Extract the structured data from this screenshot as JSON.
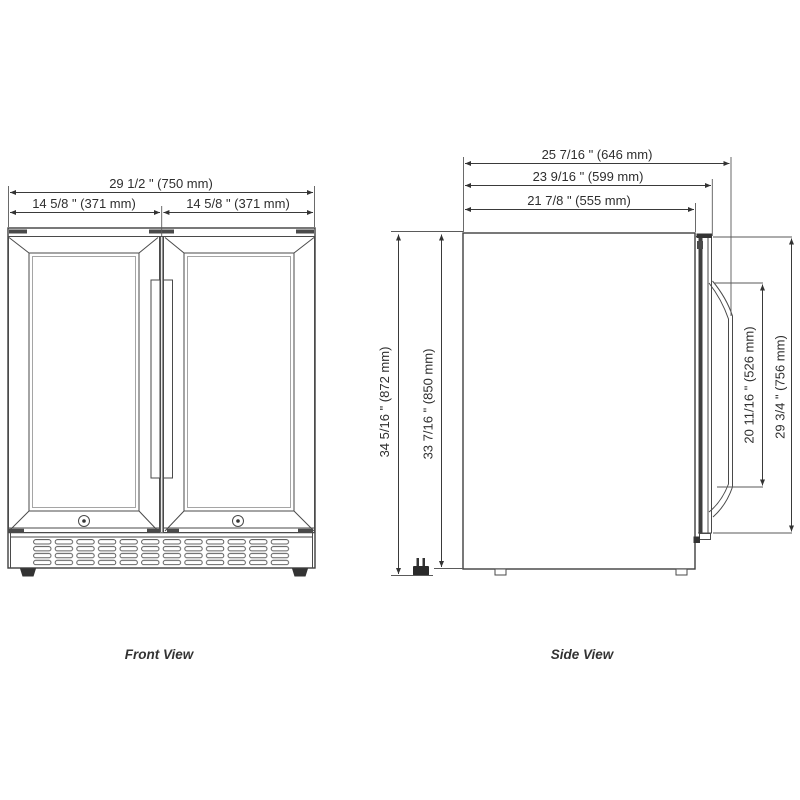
{
  "front_view": {
    "label": "Front View",
    "dimensions": {
      "overall_width": "29 1/2 \" (750 mm)",
      "left_door_width": "14 5/8 \" (371 mm)",
      "right_door_width": "14 5/8 \" (371 mm)"
    }
  },
  "side_view": {
    "label": "Side View",
    "dimensions": {
      "overall_depth": "25 7/16 \" (646 mm)",
      "depth_with_door": "23 9/16 \" (599 mm)",
      "body_depth": "21 7/8 \" (555 mm)",
      "overall_height": "34 5/16 \" (872 mm)",
      "body_height": "33 7/16 \" (850 mm)",
      "handle_length": "20 11/16 \" (526 mm)",
      "door_height": "29 3/4 \" (756 mm)"
    }
  },
  "colors": {
    "line": "#4a4a4a",
    "dimension_line": "#3a3a3a",
    "text": "#2e2e2e",
    "background": "#ffffff"
  }
}
